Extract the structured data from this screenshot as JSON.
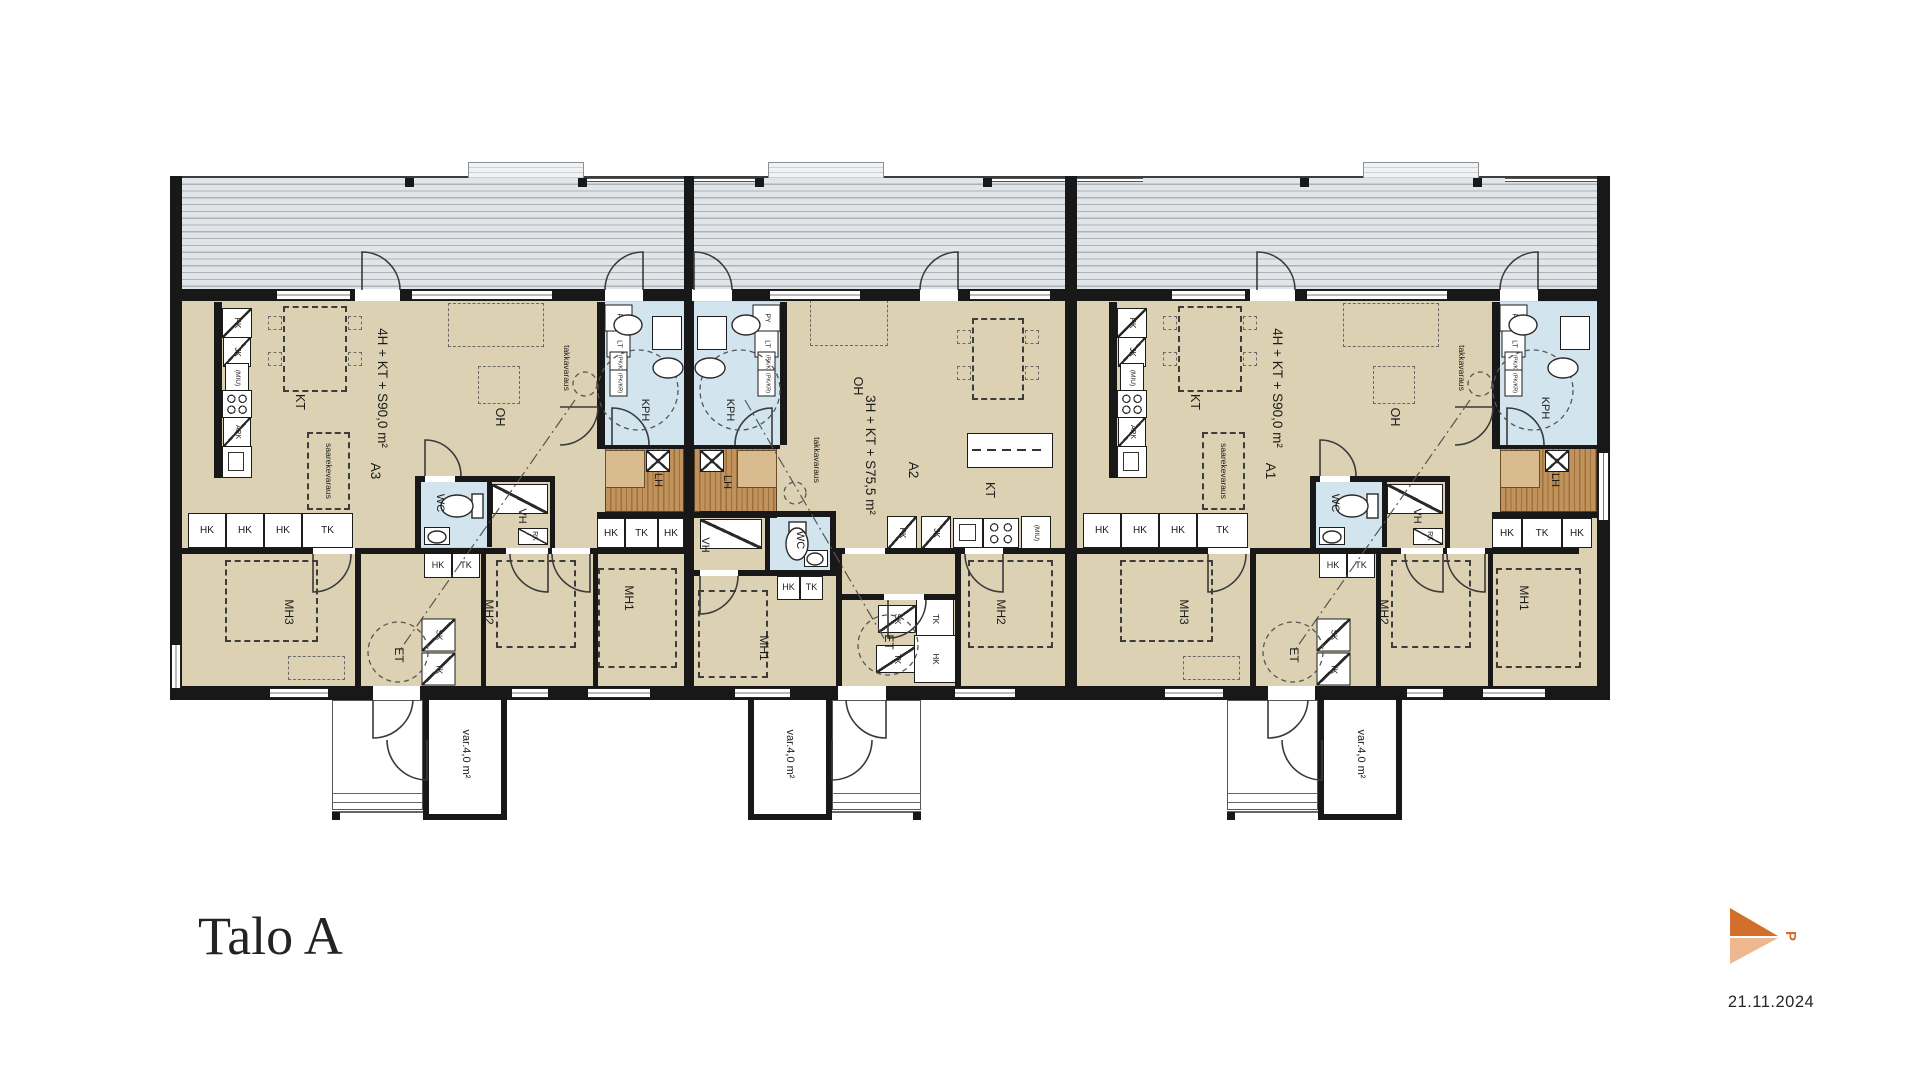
{
  "title": "Talo A",
  "date": "21.11.2024",
  "north": {
    "label": "P"
  },
  "units": [
    {
      "id": "A3",
      "type_line": "4H + KT + S",
      "area_line": "90,0 m²"
    },
    {
      "id": "A2",
      "type_line": "3H + KT + S",
      "area_line": "75,5 m²"
    },
    {
      "id": "A1",
      "type_line": "4H + KT + S",
      "area_line": "90,0 m²"
    }
  ],
  "room_labels": {
    "kt": "KT",
    "oh": "OH",
    "kph": "KPH",
    "lh": "LH",
    "wc": "WC",
    "vh": "VH",
    "et": "ET",
    "mh1": "MH1",
    "mh2": "MH2",
    "mh3": "MH3"
  },
  "storage_labels": {
    "hk": "HK",
    "tk": "TK",
    "sk": "SK",
    "rk": "RK"
  },
  "appliance_labels": {
    "pk": "PK",
    "jk": "JK",
    "miu": "(MIU)",
    "apk": "APK",
    "py": "PY",
    "lt": "LT",
    "pk_kr": "(PK/KR)"
  },
  "annotation_labels": {
    "takkavaraus": "takkavaraus",
    "saarekevaraus": "saarekevaraus",
    "var_line1": "var.",
    "var_line2": "4,0 m²"
  }
}
